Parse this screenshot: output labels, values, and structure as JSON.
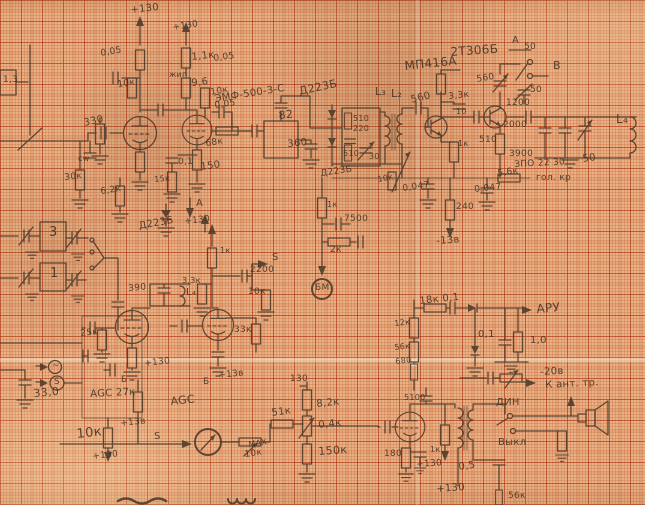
{
  "palette": {
    "paper": "#e7b287",
    "grid_major": "#b23a16",
    "grid_minor": "#c85f30",
    "ink": "#4b3828",
    "pencil_text": "#3e2f20"
  },
  "labels": [
    {
      "t": "+130",
      "x": 130,
      "y": 6,
      "s": 10,
      "r": -6
    },
    {
      "t": "+130",
      "x": 172,
      "y": 24,
      "s": 9,
      "r": -8
    },
    {
      "t": "0,05",
      "x": 100,
      "y": 50,
      "s": 9,
      "r": -10
    },
    {
      "t": "1,1к",
      "x": 191,
      "y": 53,
      "s": 10,
      "r": -6
    },
    {
      "t": "0,05",
      "x": 213,
      "y": 55,
      "s": 9,
      "r": -8
    },
    {
      "t": "жип",
      "x": 169,
      "y": 71,
      "s": 8,
      "r": 0
    },
    {
      "t": "9,6",
      "x": 191,
      "y": 79,
      "s": 10,
      "r": -6
    },
    {
      "t": "10к",
      "x": 117,
      "y": 81,
      "s": 9,
      "r": -8
    },
    {
      "t": "10к",
      "x": 210,
      "y": 89,
      "s": 9,
      "r": -10
    },
    {
      "t": "0,05",
      "x": 214,
      "y": 102,
      "s": 9,
      "r": -8
    },
    {
      "t": "330",
      "x": 83,
      "y": 119,
      "s": 10,
      "r": -12
    },
    {
      "t": "68к",
      "x": 205,
      "y": 140,
      "s": 9,
      "r": -8
    },
    {
      "t": "0,1",
      "x": 178,
      "y": 158,
      "s": 9,
      "r": 0
    },
    {
      "t": "15к",
      "x": 154,
      "y": 176,
      "s": 8,
      "r": -5
    },
    {
      "t": "150",
      "x": 200,
      "y": 163,
      "s": 10,
      "r": -8
    },
    {
      "t": "cw",
      "x": 78,
      "y": 155,
      "s": 8,
      "r": 0
    },
    {
      "t": "30к",
      "x": 64,
      "y": 174,
      "s": 9,
      "r": -6
    },
    {
      "t": "6,2к",
      "x": 100,
      "y": 188,
      "s": 9,
      "r": -8
    },
    {
      "t": "А",
      "x": 196,
      "y": 199,
      "s": 10,
      "r": 0
    },
    {
      "t": "Д223Б",
      "x": 138,
      "y": 222,
      "s": 10,
      "r": -10
    },
    {
      "t": "+130",
      "x": 184,
      "y": 218,
      "s": 9,
      "r": -6
    },
    {
      "t": "ЭМФ-500-3-С",
      "x": 214,
      "y": 95,
      "s": 10,
      "r": -9
    },
    {
      "t": "82",
      "x": 278,
      "y": 110,
      "s": 11,
      "r": -6
    },
    {
      "t": "360",
      "x": 287,
      "y": 140,
      "s": 10,
      "r": -6
    },
    {
      "t": "Д223Б",
      "x": 298,
      "y": 86,
      "s": 11,
      "r": -12
    },
    {
      "t": "510",
      "x": 353,
      "y": 115,
      "s": 8,
      "r": 0
    },
    {
      "t": "220",
      "x": 353,
      "y": 125,
      "s": 8,
      "r": 0
    },
    {
      "t": "510",
      "x": 343,
      "y": 150,
      "s": 8,
      "r": 0
    },
    {
      "t": "30",
      "x": 369,
      "y": 153,
      "s": 8,
      "r": 0
    },
    {
      "t": "L₃",
      "x": 375,
      "y": 86,
      "s": 11,
      "r": 0
    },
    {
      "t": "L₂",
      "x": 391,
      "y": 88,
      "s": 11,
      "r": 0
    },
    {
      "t": "560",
      "x": 410,
      "y": 96,
      "s": 10,
      "r": -14
    },
    {
      "t": "МП416А",
      "x": 404,
      "y": 60,
      "s": 12,
      "r": -6
    },
    {
      "t": "2Т306Б",
      "x": 450,
      "y": 46,
      "s": 12,
      "r": -4
    },
    {
      "t": "3,3к",
      "x": 448,
      "y": 93,
      "s": 9,
      "r": -6
    },
    {
      "t": "10",
      "x": 456,
      "y": 108,
      "s": 8,
      "r": 0
    },
    {
      "t": "560",
      "x": 476,
      "y": 76,
      "s": 9,
      "r": -10
    },
    {
      "t": "А",
      "x": 512,
      "y": 36,
      "s": 10,
      "r": 0
    },
    {
      "t": "50",
      "x": 524,
      "y": 43,
      "s": 9,
      "r": 0
    },
    {
      "t": "В",
      "x": 553,
      "y": 60,
      "s": 11,
      "r": 0
    },
    {
      "t": "50",
      "x": 530,
      "y": 86,
      "s": 9,
      "r": 0
    },
    {
      "t": "1200",
      "x": 506,
      "y": 99,
      "s": 9,
      "r": 0
    },
    {
      "t": "2000",
      "x": 503,
      "y": 121,
      "s": 9,
      "r": 0
    },
    {
      "t": "510",
      "x": 479,
      "y": 136,
      "s": 9,
      "r": 0
    },
    {
      "t": "1к",
      "x": 458,
      "y": 140,
      "s": 8,
      "r": 0
    },
    {
      "t": "3900",
      "x": 509,
      "y": 150,
      "s": 9,
      "r": 0
    },
    {
      "t": "50",
      "x": 582,
      "y": 155,
      "s": 10,
      "r": -8
    },
    {
      "t": "ЗПО 22 30",
      "x": 514,
      "y": 161,
      "s": 9,
      "r": -3
    },
    {
      "t": "гол. кр",
      "x": 536,
      "y": 174,
      "s": 9,
      "r": 0
    },
    {
      "t": "L₄",
      "x": 616,
      "y": 113,
      "s": 12,
      "r": 0
    },
    {
      "t": "10к",
      "x": 377,
      "y": 176,
      "s": 8,
      "r": -10
    },
    {
      "t": "0,047",
      "x": 402,
      "y": 185,
      "s": 9,
      "r": -8
    },
    {
      "t": "0,047",
      "x": 474,
      "y": 186,
      "s": 9,
      "r": -6
    },
    {
      "t": "5,6к",
      "x": 497,
      "y": 170,
      "s": 9,
      "r": -8
    },
    {
      "t": "240",
      "x": 456,
      "y": 203,
      "s": 9,
      "r": 0
    },
    {
      "t": "-13в",
      "x": 436,
      "y": 237,
      "s": 10,
      "r": -4
    },
    {
      "t": "Д223Б",
      "x": 320,
      "y": 170,
      "s": 9,
      "r": -8
    },
    {
      "t": "1к",
      "x": 327,
      "y": 201,
      "s": 8,
      "r": 0
    },
    {
      "t": "7500",
      "x": 344,
      "y": 215,
      "s": 9,
      "r": 0
    },
    {
      "t": "2к",
      "x": 330,
      "y": 246,
      "s": 9,
      "r": 0
    },
    {
      "t": "БМ",
      "x": 315,
      "y": 284,
      "s": 9,
      "r": 0
    },
    {
      "t": "1к",
      "x": 220,
      "y": 247,
      "s": 8,
      "r": 0
    },
    {
      "t": "2200",
      "x": 250,
      "y": 266,
      "s": 9,
      "r": 0
    },
    {
      "t": "3,3к",
      "x": 182,
      "y": 277,
      "s": 8,
      "r": 0
    },
    {
      "t": "10к",
      "x": 248,
      "y": 288,
      "s": 9,
      "r": 0
    },
    {
      "t": "S",
      "x": 272,
      "y": 253,
      "s": 10,
      "r": 0
    },
    {
      "t": "3",
      "x": 49,
      "y": 226,
      "s": 13,
      "r": 0
    },
    {
      "t": "1",
      "x": 50,
      "y": 267,
      "s": 13,
      "r": 0
    },
    {
      "t": "390",
      "x": 128,
      "y": 285,
      "s": 9,
      "r": -5
    },
    {
      "t": "L₄",
      "x": 186,
      "y": 288,
      "s": 10,
      "r": 0
    },
    {
      "t": "1,3",
      "x": 3,
      "y": 76,
      "s": 9,
      "r": 0
    },
    {
      "t": "33,0",
      "x": 33,
      "y": 388,
      "s": 11,
      "r": -5
    },
    {
      "t": "S",
      "x": 54,
      "y": 378,
      "s": 9,
      "r": 0
    },
    {
      "t": "~",
      "x": 52,
      "y": 362,
      "s": 9,
      "r": 0
    },
    {
      "t": "25к",
      "x": 80,
      "y": 330,
      "s": 9,
      "r": -6
    },
    {
      "t": "AGC 27к",
      "x": 90,
      "y": 390,
      "s": 10,
      "r": -3
    },
    {
      "t": "Б",
      "x": 121,
      "y": 376,
      "s": 9,
      "r": 0
    },
    {
      "t": "Б",
      "x": 203,
      "y": 378,
      "s": 9,
      "r": 0
    },
    {
      "t": "10к",
      "x": 76,
      "y": 428,
      "s": 13,
      "r": -6
    },
    {
      "t": "+130",
      "x": 92,
      "y": 453,
      "s": 9,
      "r": -6
    },
    {
      "t": "+13в",
      "x": 120,
      "y": 420,
      "s": 9,
      "r": -6
    },
    {
      "t": "+130",
      "x": 144,
      "y": 360,
      "s": 9,
      "r": -6
    },
    {
      "t": "+13в",
      "x": 218,
      "y": 372,
      "s": 9,
      "r": -6
    },
    {
      "t": "AGC",
      "x": 170,
      "y": 396,
      "s": 11,
      "r": -6
    },
    {
      "t": "33к",
      "x": 234,
      "y": 326,
      "s": 9,
      "r": 0
    },
    {
      "t": "130",
      "x": 290,
      "y": 375,
      "s": 9,
      "r": 0
    },
    {
      "t": "8,2к",
      "x": 316,
      "y": 400,
      "s": 10,
      "r": -6
    },
    {
      "t": "51к",
      "x": 271,
      "y": 409,
      "s": 10,
      "r": -8
    },
    {
      "t": "0,4к",
      "x": 318,
      "y": 421,
      "s": 10,
      "r": -6
    },
    {
      "t": "150к",
      "x": 318,
      "y": 446,
      "s": 11,
      "r": -4
    },
    {
      "t": "МАХ",
      "x": 248,
      "y": 441,
      "s": 8,
      "r": -8
    },
    {
      "t": "10к",
      "x": 244,
      "y": 451,
      "s": 9,
      "r": -8
    },
    {
      "t": "S",
      "x": 154,
      "y": 432,
      "s": 10,
      "r": 0
    },
    {
      "t": "12к",
      "x": 394,
      "y": 320,
      "s": 8,
      "r": -6
    },
    {
      "t": "56к",
      "x": 394,
      "y": 344,
      "s": 8,
      "r": -6
    },
    {
      "t": "680",
      "x": 395,
      "y": 358,
      "s": 8,
      "r": -6
    },
    {
      "t": "18к 0,1",
      "x": 419,
      "y": 297,
      "s": 10,
      "r": -6
    },
    {
      "t": "0,1",
      "x": 478,
      "y": 330,
      "s": 10,
      "r": 0
    },
    {
      "t": "1,0",
      "x": 530,
      "y": 336,
      "s": 10,
      "r": 0
    },
    {
      "t": "АРУ",
      "x": 536,
      "y": 303,
      "s": 12,
      "r": -5
    },
    {
      "t": "-20в",
      "x": 540,
      "y": 368,
      "s": 10,
      "r": -3
    },
    {
      "t": "К ант. тр.",
      "x": 545,
      "y": 381,
      "s": 10,
      "r": -3
    },
    {
      "t": "ДИН",
      "x": 496,
      "y": 398,
      "s": 10,
      "r": 0
    },
    {
      "t": "Выкл",
      "x": 498,
      "y": 438,
      "s": 10,
      "r": 0
    },
    {
      "t": "5100",
      "x": 404,
      "y": 394,
      "s": 8,
      "r": 0
    },
    {
      "t": "1к",
      "x": 430,
      "y": 446,
      "s": 8,
      "r": 0
    },
    {
      "t": "180",
      "x": 384,
      "y": 450,
      "s": 9,
      "r": 0
    },
    {
      "t": "+130",
      "x": 416,
      "y": 461,
      "s": 9,
      "r": -4
    },
    {
      "t": "+130",
      "x": 436,
      "y": 485,
      "s": 10,
      "r": -4
    },
    {
      "t": "0,5",
      "x": 458,
      "y": 463,
      "s": 10,
      "r": -8
    },
    {
      "t": "56к",
      "x": 508,
      "y": 492,
      "s": 9,
      "r": 0
    }
  ]
}
